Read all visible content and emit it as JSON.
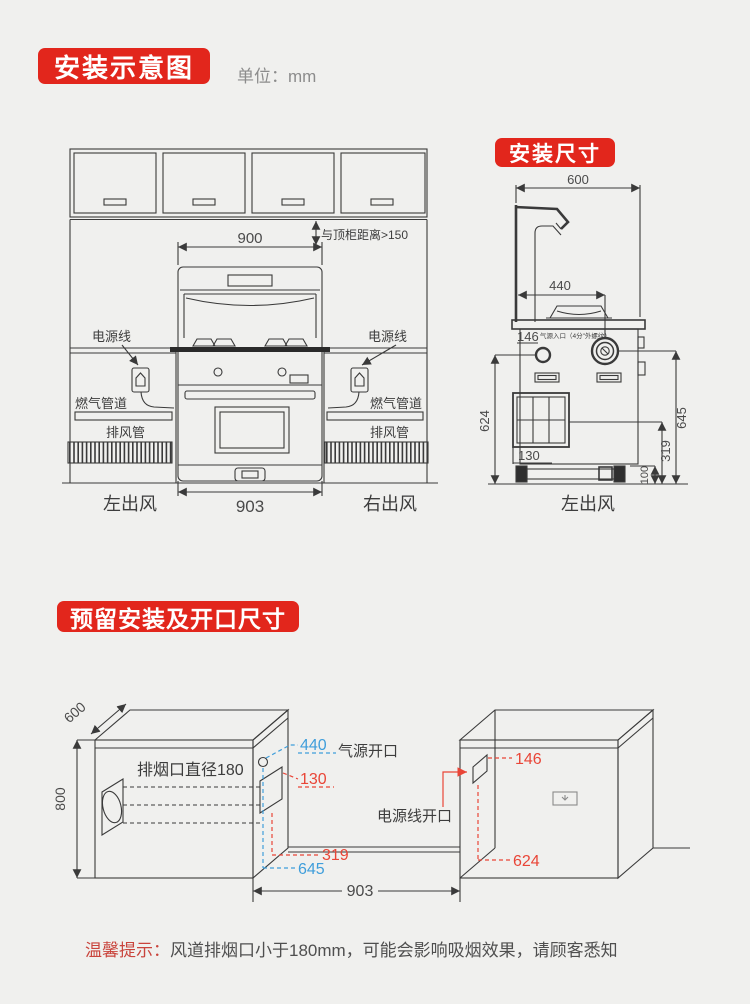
{
  "page": {
    "unit": "单位：mm"
  },
  "badges": {
    "install_diagram": "安装示意图",
    "install_size": "安装尺寸",
    "reserved_opening": "预留安装及开口尺寸"
  },
  "front_view": {
    "dim_width_top": "900",
    "top_gap_note": "与顶柜距离>150",
    "power_cord_left": "电源线",
    "power_cord_right": "电源线",
    "gas_pipe_left": "燃气管道",
    "gas_pipe_right": "燃气管道",
    "exhaust_duct_left": "排风管",
    "exhaust_duct_right": "排风管",
    "dim_width_bottom": "903",
    "air_out_left": "左出风",
    "air_out_right": "右出风"
  },
  "side_view": {
    "dim_depth": "600",
    "dim_burner": "440",
    "dim_gas_inlet": "146",
    "gas_inlet_note": "气源入口（4分\"外螺纹）",
    "dim_left_height": "624",
    "dim_right_height": "645",
    "dim_outlet_height": "319",
    "dim_base_height": "100",
    "dim_outlet_offset": "130",
    "air_out": "左出风"
  },
  "opening_view": {
    "dim_depth": "600",
    "dim_height": "800",
    "smoke_outlet": "排烟口直径180",
    "dim_gas_x": "440",
    "gas_opening": "气源开口",
    "dim_duct_offset": "130",
    "dim_power_x": "146",
    "power_opening": "电源线开口",
    "dim_duct_height": "319",
    "dim_gas_height": "645",
    "dim_gap_width": "903",
    "dim_power_height": "624"
  },
  "footer": {
    "tip_label": "温馨提示：",
    "tip_text": "风道排烟口小于180mm，可能会影响吸烟效果，请顾客悉知"
  },
  "colors": {
    "badge_red": "#e2261c",
    "dim_blue": "#3f9edb",
    "dim_red": "#e94537",
    "line": "#3a3a3a"
  }
}
